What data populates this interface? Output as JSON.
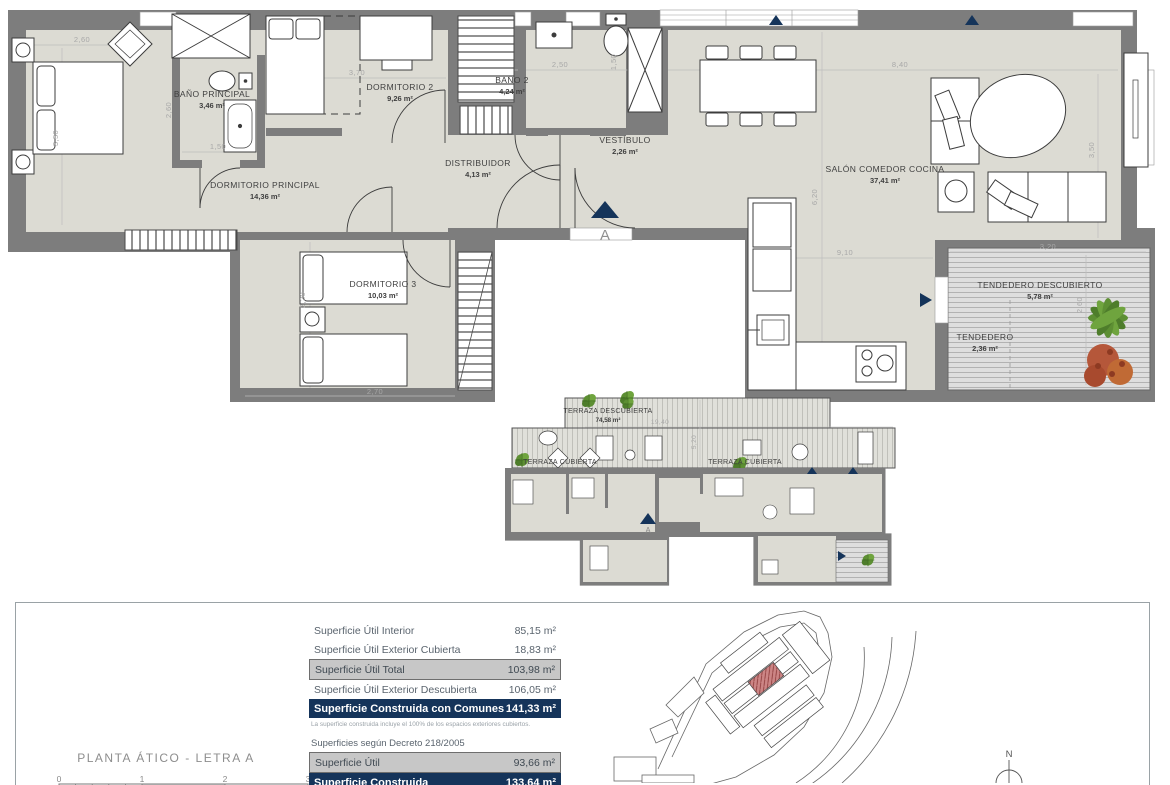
{
  "plan": {
    "marker": "A",
    "rooms": {
      "dormitorio_principal": {
        "name": "DORMITORIO PRINCIPAL",
        "area": "14,36 m²"
      },
      "bano_principal": {
        "name": "BAÑO PRINCIPAL",
        "area": "3,46 m²"
      },
      "dormitorio_2": {
        "name": "DORMITORIO 2",
        "area": "9,26 m²"
      },
      "bano_2": {
        "name": "BAÑO 2",
        "area": "4,24 m²"
      },
      "vestibulo": {
        "name": "VESTÍBULO",
        "area": "2,26 m²"
      },
      "distribuidor": {
        "name": "DISTRIBUIDOR",
        "area": "4,13 m²"
      },
      "dormitorio_3": {
        "name": "DORMITORIO 3",
        "area": "10,03 m²"
      },
      "salon": {
        "name": "SALÓN COMEDOR COCINA",
        "area": "37,41 m²"
      },
      "tendedero_descubierto": {
        "name": "TENDEDERO DESCUBIERTO",
        "area": "5,78 m²"
      },
      "tendedero": {
        "name": "TENDEDERO",
        "area": "2,36 m²"
      }
    },
    "dims": {
      "dp_top": "2,60",
      "dp_left": "3,50",
      "banop_left": "2,60",
      "banop_w": "1,50",
      "d2_w": "3,70",
      "bano2_w": "2,50",
      "bano2_right": "1,50",
      "salon_w": "8,40",
      "salon_right": "3,50",
      "salon_left": "6,20",
      "cocina_w": "9,10",
      "tend_w": "3,20",
      "tend_right": "2,60",
      "d3_left": "3,20",
      "d3_w": "2,70"
    }
  },
  "terrace_plan": {
    "marker": "A",
    "rooms": {
      "terraza_descubierta": {
        "name": "TERRAZA DESCUBIERTA",
        "area": "74,58 m²"
      },
      "terraza_cubierta_izq": {
        "name": "TERRAZA CUBIERTA",
        "area": "2,42 m²"
      },
      "terraza_cubierta_der": {
        "name": "TERRAZA CUBIERTA",
        "area": "8,48 m²"
      }
    },
    "dims": {
      "w": "19,40",
      "h": "5,20"
    }
  },
  "info_panel": {
    "plan_title": "PLANTA ÁTICO - LETRA A",
    "scale_ticks": [
      "0",
      "1",
      "2",
      "3"
    ],
    "areas_table": {
      "rows": [
        {
          "label": "Superficie Útil Interior",
          "value": "85,15 m²"
        },
        {
          "label": "Superficie Útil Exterior Cubierta",
          "value": "18,83 m²"
        },
        {
          "label": "Superficie Útil Total",
          "value": "103,98 m²"
        },
        {
          "label": "Superficie Útil Exterior Descubierta",
          "value": "106,05 m²"
        },
        {
          "label": "Superficie Construida con Comunes",
          "value": "141,33 m²"
        }
      ],
      "footnote": "La superficie construida incluye el 100% de los espacios exteriores cubiertos."
    },
    "decree_table": {
      "title": "Superficies según Decreto 218/2005",
      "rows": [
        {
          "label": "Superficie Útil",
          "value": "93,66 m²"
        },
        {
          "label": "Superficie Construida",
          "value": "133,64 m²"
        }
      ]
    },
    "compass": "N"
  },
  "colors": {
    "wall": "#7d7d7d",
    "floor": "#dcdbd3",
    "navy": "#15345a",
    "highlight_gray": "#c7c7c7",
    "unit_red": "#cc8585"
  }
}
